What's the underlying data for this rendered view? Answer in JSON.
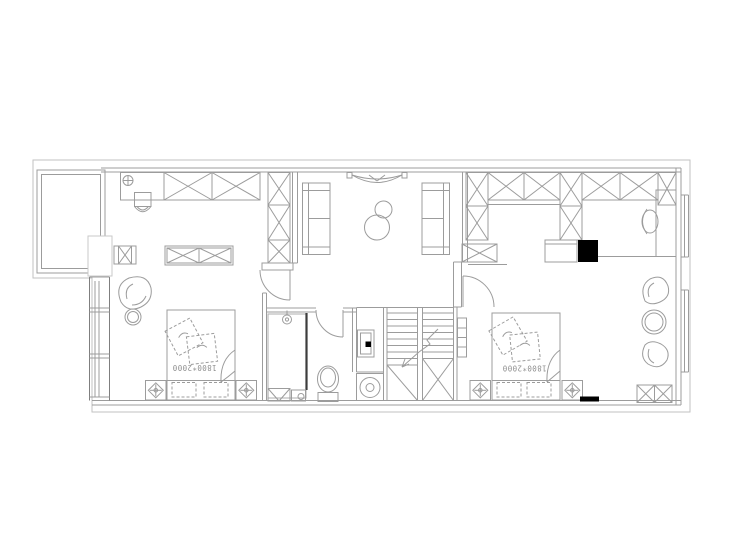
{
  "plan": {
    "bedroom_left": {
      "bed_size_label": "1800*2000"
    },
    "bedroom_right": {
      "bed_size_label": "1800*2000"
    },
    "colors": {
      "background": "#ffffff",
      "line": "#9c9c9c",
      "wall": "#7f7f7f",
      "boundary": "#c2c2c2",
      "accent_black": "#000000",
      "label_text": "#8f8f8f"
    }
  }
}
